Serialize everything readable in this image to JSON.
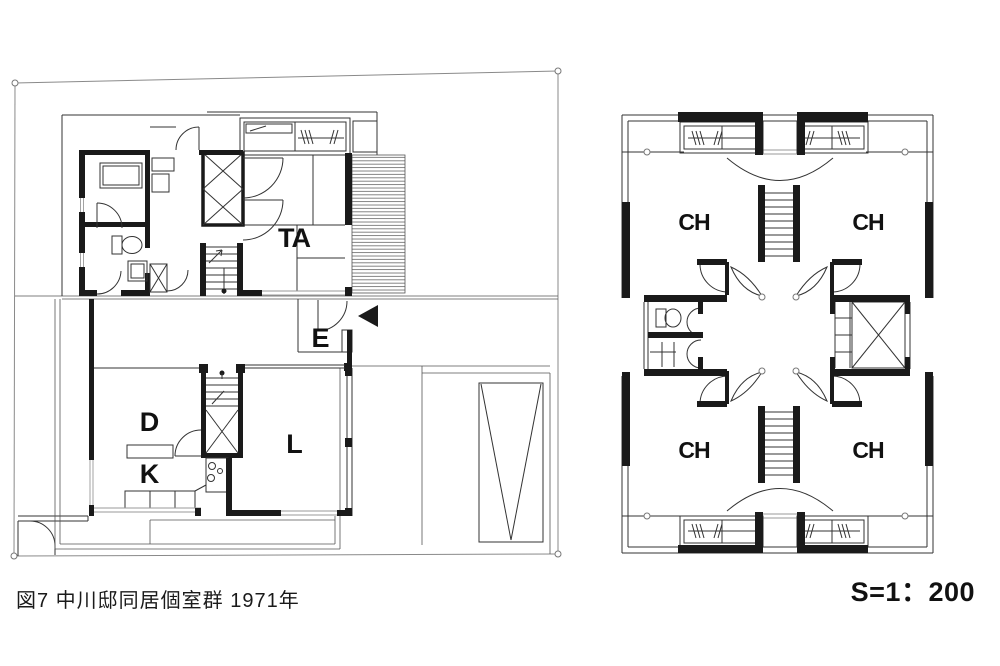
{
  "figure": {
    "caption": "図7 中川邸同居個室群 1971年",
    "scale_label": "S=1：200"
  },
  "floor1": {
    "name": "first floor plan",
    "rooms": {
      "ta": "TA",
      "e": "E",
      "d": "D",
      "k": "K",
      "l": "L"
    }
  },
  "floor2": {
    "name": "second floor plan",
    "rooms": {
      "nw": "CH",
      "ne": "CH",
      "sw": "CH",
      "se": "CH"
    }
  },
  "colors": {
    "wall": "#1a1a1a",
    "thin_line": "#333333",
    "light_line": "#999999",
    "background": "#ffffff"
  }
}
